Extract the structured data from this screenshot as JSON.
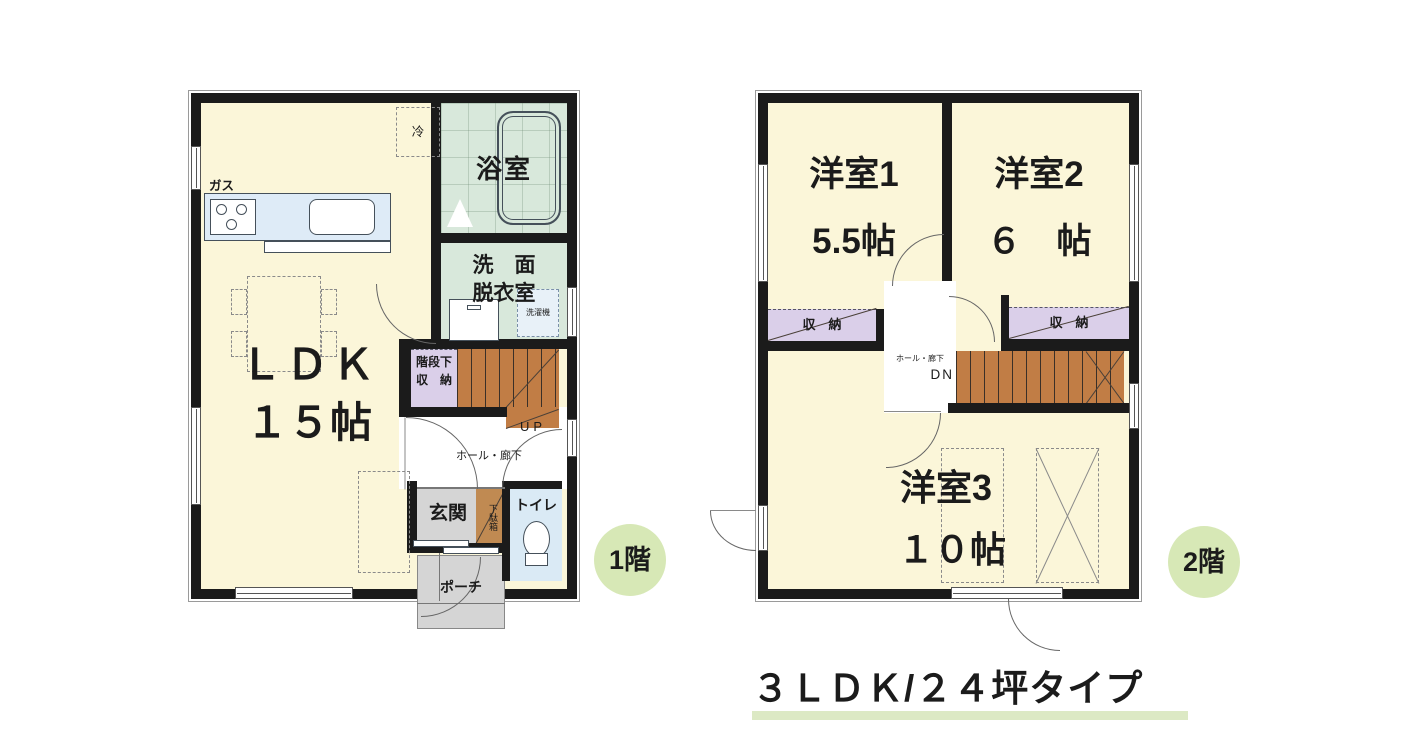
{
  "caption": {
    "text": "３ＬＤＫ/２４坪タイプ"
  },
  "floor1": {
    "badge": "1階",
    "labels": {
      "gas": "ガス",
      "fridge": "冷",
      "bathroom": "浴室",
      "washroom_line1": "洗　面",
      "washroom_line2": "脱衣室",
      "laundry": "洗濯機",
      "ldk_line1": "ＬＤＫ",
      "ldk_line2": "１５帖",
      "stair_storage_line1": "階段下",
      "stair_storage_line2": "収　納",
      "up": "UP",
      "hall": "ホール・廊下",
      "entrance": "玄関",
      "shoe_cabinet": "下駄箱",
      "toilet": "トイレ",
      "porch": "ポーチ"
    }
  },
  "floor2": {
    "badge": "2階",
    "labels": {
      "bedroom1_line1": "洋室1",
      "bedroom1_line2": "5.5帖",
      "bedroom2_line1": "洋室2",
      "bedroom2_line2": "６　帖",
      "bedroom3_line1": "洋室3",
      "bedroom3_line2": "１０帖",
      "closet_left": "収　納",
      "closet_right": "収　納",
      "hall": "ホール・廊下",
      "down": "DN"
    }
  },
  "colors": {
    "room_cream": "#FBF6D9",
    "wall_black": "#1B1B1B",
    "bath_green": "#D8E8DB",
    "toilet_blue": "#DAEAF5",
    "kitchen_blue": "#DEEBF7",
    "storage_purple": "#DACFE9",
    "stair_brown": "#C17D45",
    "entrance_gray": "#D5D5D5",
    "badge_green": "#D7E8B6",
    "underline_green": "#DCE9C4"
  }
}
